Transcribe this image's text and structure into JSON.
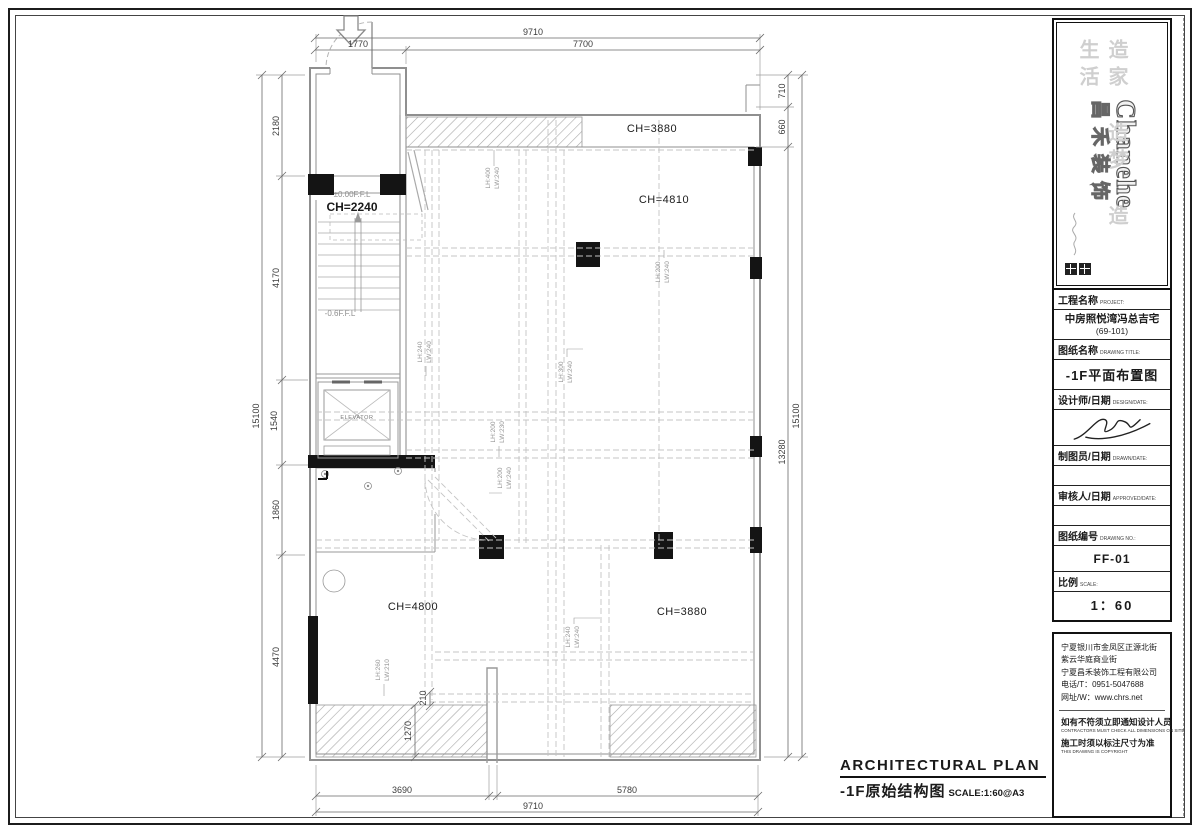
{
  "logo_panel": {
    "brand_en": "Chanehe",
    "brand_cn": "昌禾装饰",
    "slogan": "造家 造梦 造生活"
  },
  "title_block": {
    "project_label": "工程名称",
    "project_label_en": "PROJECT:",
    "project_value": "中房照悦湾冯总吉宅",
    "project_value2": "(69-101)",
    "drawing_label": "图纸名称",
    "drawing_label_en": "DRAWING TITLE:",
    "drawing_value": "-1F平面布置图",
    "designer_label": "设计师/日期",
    "designer_label_en": "DESIGN/DATE:",
    "drafter_label": "制图员/日期",
    "drafter_label_en": "DRAWN/DATE:",
    "approver_label": "审核人/日期",
    "approver_label_en": "APPROVED/DATE:",
    "number_label": "图纸编号",
    "number_label_en": "DRAWING NO.:",
    "number_value": "FF-01",
    "scale_label": "比例",
    "scale_label_en": "SCALE:",
    "scale_value": "1：60"
  },
  "address_block": {
    "line1": "宁夏银川市金凤区正源北街",
    "line2": "紫云华庭商业街",
    "line3": "宁夏昌禾装饰工程有限公司",
    "phone": "电话/T：0951-5047688",
    "website": "网址/W：www.chrs.net",
    "notice1": "如有不符须立即通知设计人员",
    "notice1_en": "CONTRACTORS MUST CHECK ALL DIMENSIONS ON SITE",
    "notice2": "施工时须以标注尺寸为准",
    "notice2_en": "THIS DRAWING IS COPYRIGHT"
  },
  "plan_title": {
    "en": "ARCHITECTURAL PLAN",
    "cn": "-1F原始结构图",
    "scale": "SCALE:1:60@A3"
  },
  "dimensions": {
    "top": {
      "total": "9710",
      "segs": [
        "1770",
        "7700"
      ]
    },
    "bottom": {
      "total": "9710",
      "segs": [
        "3690",
        "5780"
      ]
    },
    "left": {
      "total": "15100",
      "segs": [
        "2180",
        "4170",
        "1540",
        "1860",
        "4470"
      ]
    },
    "right": {
      "total": "15100",
      "segs": [
        "710",
        "660",
        "13280"
      ]
    },
    "inner": {
      "d1": "1270",
      "d2": "210"
    }
  },
  "rooms": {
    "ch_top": "CH=3880",
    "ch_main": "CH=4810",
    "ch_stair": "CH=2240",
    "ch_left": "CH=4800",
    "ch_bottom": "CH=3880",
    "ffl_zero": "±0.00F.F.L",
    "ffl_minus": "-0.6F.F.L",
    "elevator": "ELEVATOR"
  },
  "beams": [
    {
      "lh": "LH:400",
      "lw": "LW:240"
    },
    {
      "lh": "LH:200",
      "lw": "LW:240"
    },
    {
      "lh": "LH:240",
      "lw": "LW:240"
    },
    {
      "lh": "LH:300",
      "lw": "LW:240"
    },
    {
      "lh": "LH:200",
      "lw": "LW:230"
    },
    {
      "lh": "LH:200",
      "lw": "LW:240"
    },
    {
      "lh": "LH:240",
      "lw": "LW:240"
    },
    {
      "lh": "LH:260",
      "lw": "LW:210"
    }
  ],
  "colors": {
    "wall": "#8f8f8f",
    "dash": "#bdbdbd",
    "dim": "#5a5a5a",
    "ink": "#111111"
  }
}
